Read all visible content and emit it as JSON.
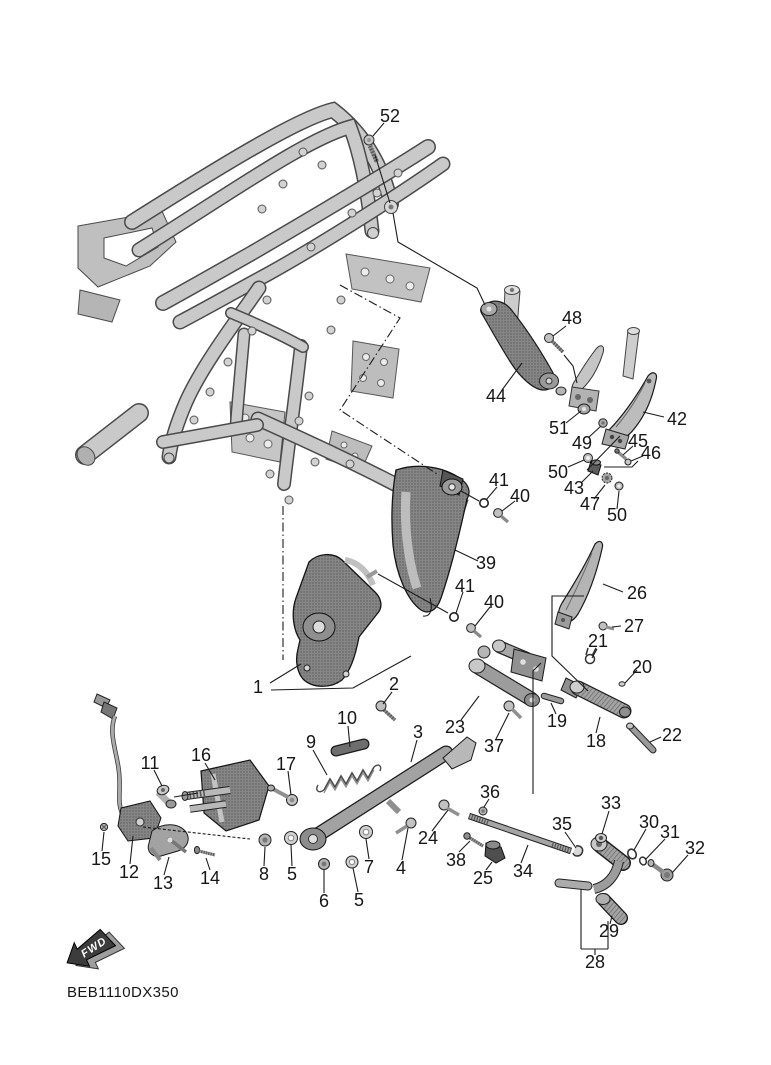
{
  "diagram": {
    "figure_code": "BEB1110DX350",
    "fwd_label": "FWD",
    "callouts": [
      {
        "n": "52",
        "x": 390,
        "y": 116,
        "k": "52"
      },
      {
        "n": "48",
        "x": 572,
        "y": 318,
        "k": "48"
      },
      {
        "n": "44",
        "x": 496,
        "y": 396,
        "k": "44"
      },
      {
        "n": "42",
        "x": 677,
        "y": 419,
        "k": "42"
      },
      {
        "n": "51",
        "x": 559,
        "y": 428,
        "k": "51"
      },
      {
        "n": "49",
        "x": 582,
        "y": 443,
        "k": "49"
      },
      {
        "n": "45",
        "x": 638,
        "y": 441,
        "k": "45"
      },
      {
        "n": "46",
        "x": 651,
        "y": 453,
        "k": "46"
      },
      {
        "n": "50",
        "x": 558,
        "y": 472,
        "k": "50a"
      },
      {
        "n": "43",
        "x": 574,
        "y": 488,
        "k": "43"
      },
      {
        "n": "47",
        "x": 590,
        "y": 504,
        "k": "47"
      },
      {
        "n": "50",
        "x": 617,
        "y": 515,
        "k": "50b"
      },
      {
        "n": "41",
        "x": 499,
        "y": 480,
        "k": "41a"
      },
      {
        "n": "40",
        "x": 520,
        "y": 496,
        "k": "40a"
      },
      {
        "n": "39",
        "x": 486,
        "y": 563,
        "k": "39"
      },
      {
        "n": "41",
        "x": 465,
        "y": 586,
        "k": "41b"
      },
      {
        "n": "40",
        "x": 494,
        "y": 602,
        "k": "40b"
      },
      {
        "n": "26",
        "x": 637,
        "y": 593,
        "k": "26"
      },
      {
        "n": "27",
        "x": 634,
        "y": 626,
        "k": "27"
      },
      {
        "n": "21",
        "x": 598,
        "y": 641,
        "k": "21"
      },
      {
        "n": "20",
        "x": 642,
        "y": 667,
        "k": "20"
      },
      {
        "n": "19",
        "x": 557,
        "y": 721,
        "k": "19"
      },
      {
        "n": "18",
        "x": 596,
        "y": 741,
        "k": "18"
      },
      {
        "n": "22",
        "x": 672,
        "y": 735,
        "k": "22"
      },
      {
        "n": "1",
        "x": 258,
        "y": 687,
        "k": "1"
      },
      {
        "n": "2",
        "x": 394,
        "y": 684,
        "k": "2"
      },
      {
        "n": "10",
        "x": 347,
        "y": 718,
        "k": "10"
      },
      {
        "n": "9",
        "x": 311,
        "y": 742,
        "k": "9"
      },
      {
        "n": "3",
        "x": 418,
        "y": 732,
        "k": "3"
      },
      {
        "n": "23",
        "x": 455,
        "y": 727,
        "k": "23"
      },
      {
        "n": "37",
        "x": 494,
        "y": 746,
        "k": "37"
      },
      {
        "n": "16",
        "x": 201,
        "y": 755,
        "k": "16"
      },
      {
        "n": "11",
        "x": 150,
        "y": 763,
        "k": "11"
      },
      {
        "n": "17",
        "x": 286,
        "y": 764,
        "k": "17"
      },
      {
        "n": "15",
        "x": 101,
        "y": 859,
        "k": "15"
      },
      {
        "n": "12",
        "x": 129,
        "y": 872,
        "k": "12"
      },
      {
        "n": "13",
        "x": 163,
        "y": 883,
        "k": "13"
      },
      {
        "n": "14",
        "x": 210,
        "y": 878,
        "k": "14"
      },
      {
        "n": "8",
        "x": 264,
        "y": 874,
        "k": "8"
      },
      {
        "n": "5",
        "x": 292,
        "y": 874,
        "k": "5a"
      },
      {
        "n": "6",
        "x": 324,
        "y": 901,
        "k": "6"
      },
      {
        "n": "5",
        "x": 359,
        "y": 900,
        "k": "5b"
      },
      {
        "n": "7",
        "x": 369,
        "y": 867,
        "k": "7"
      },
      {
        "n": "4",
        "x": 401,
        "y": 868,
        "k": "4"
      },
      {
        "n": "36",
        "x": 490,
        "y": 792,
        "k": "36"
      },
      {
        "n": "24",
        "x": 428,
        "y": 838,
        "k": "24"
      },
      {
        "n": "38",
        "x": 456,
        "y": 860,
        "k": "38"
      },
      {
        "n": "25",
        "x": 483,
        "y": 878,
        "k": "25"
      },
      {
        "n": "34",
        "x": 523,
        "y": 871,
        "k": "34"
      },
      {
        "n": "35",
        "x": 562,
        "y": 824,
        "k": "35"
      },
      {
        "n": "33",
        "x": 611,
        "y": 803,
        "k": "33"
      },
      {
        "n": "30",
        "x": 649,
        "y": 822,
        "k": "30"
      },
      {
        "n": "31",
        "x": 670,
        "y": 832,
        "k": "31"
      },
      {
        "n": "32",
        "x": 695,
        "y": 848,
        "k": "32"
      },
      {
        "n": "29",
        "x": 609,
        "y": 931,
        "k": "29"
      },
      {
        "n": "28",
        "x": 595,
        "y": 962,
        "k": "28"
      }
    ]
  }
}
